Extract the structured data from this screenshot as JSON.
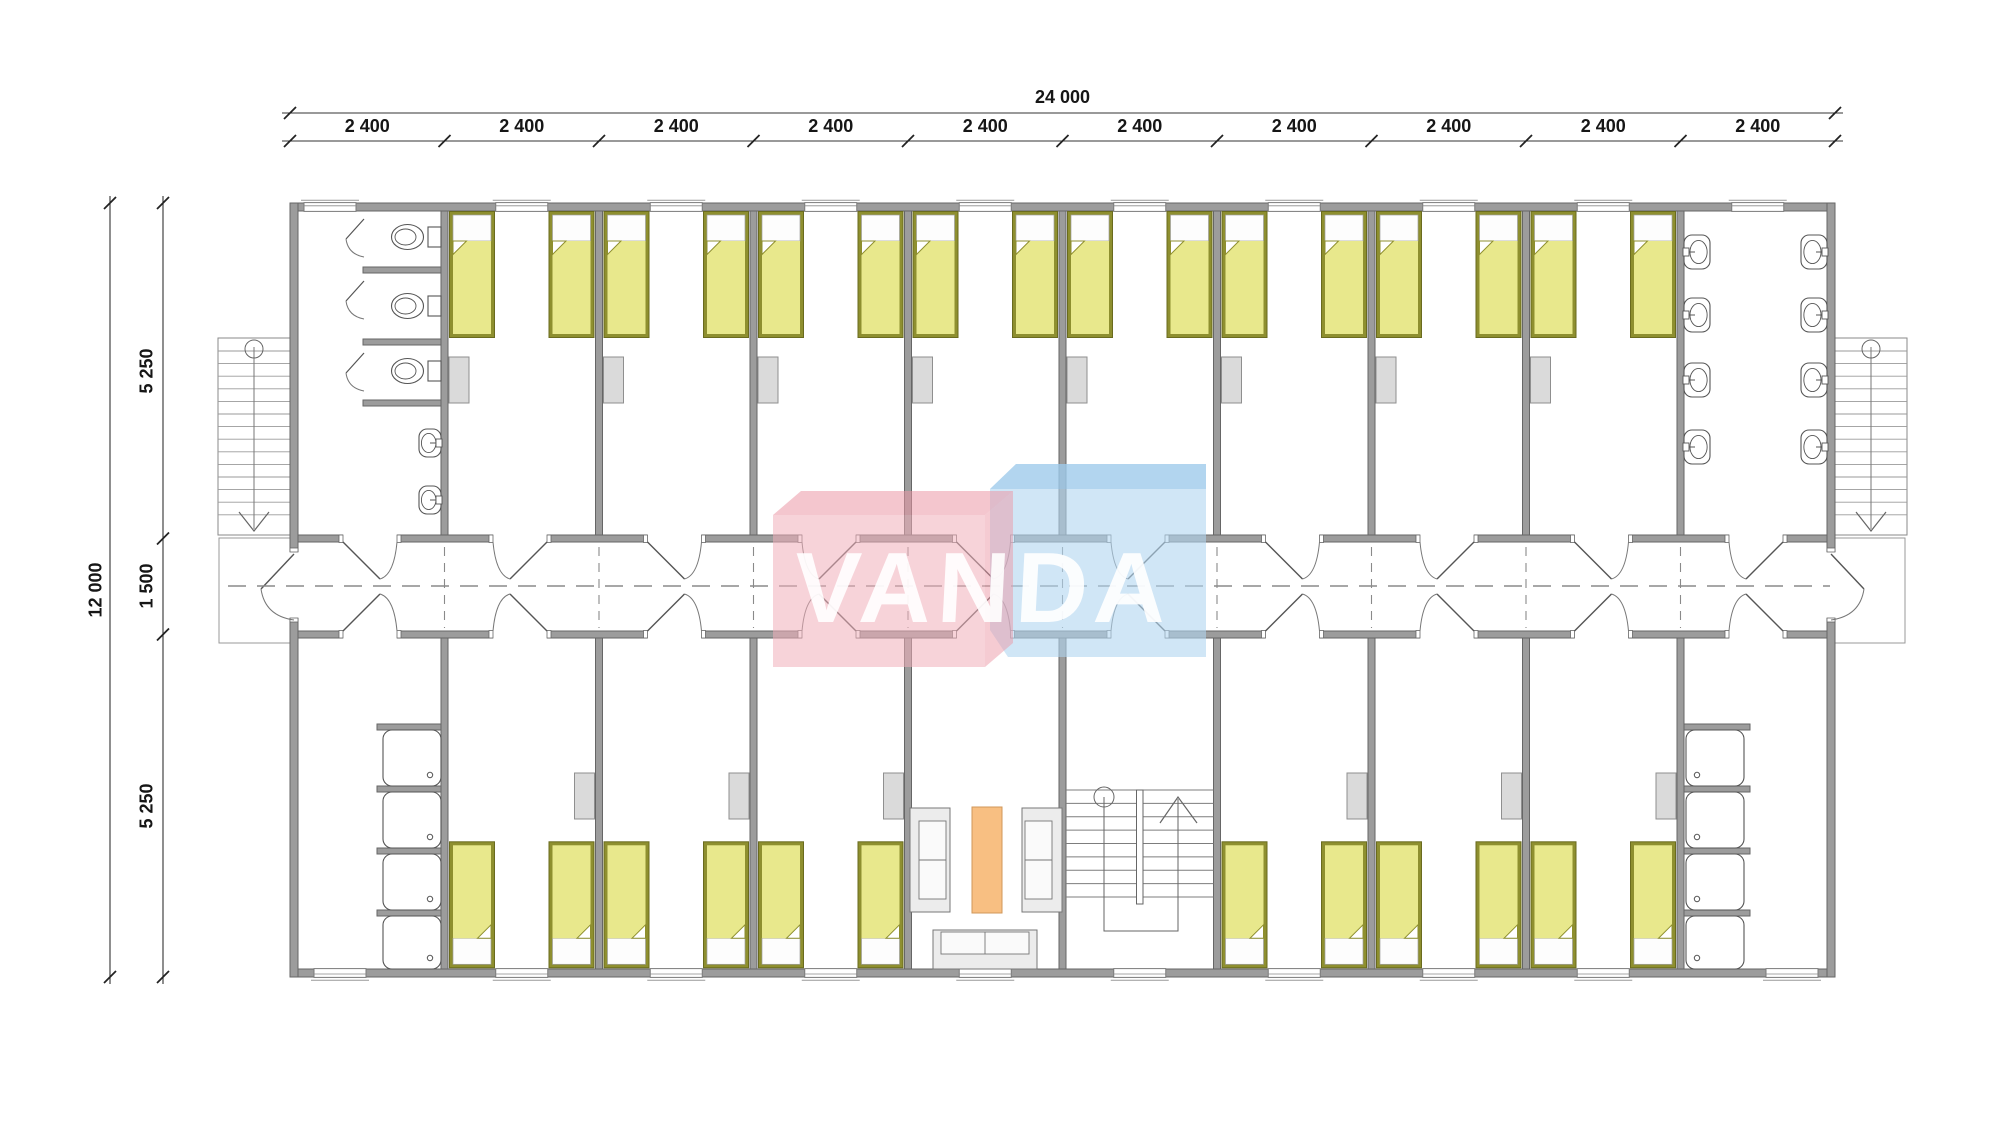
{
  "title": "Dormitory module floor plan",
  "brand": {
    "name": "VANDA"
  },
  "dimensions": {
    "top_total": {
      "label": "24 000"
    },
    "top_segments": [
      {
        "label": "2 400"
      },
      {
        "label": "2 400"
      },
      {
        "label": "2 400"
      },
      {
        "label": "2 400"
      },
      {
        "label": "2 400"
      },
      {
        "label": "2 400"
      },
      {
        "label": "2 400"
      },
      {
        "label": "2 400"
      },
      {
        "label": "2 400"
      },
      {
        "label": "2 400"
      }
    ],
    "left_total": {
      "label": "12 000"
    },
    "left_segments": [
      {
        "label": "5 250"
      },
      {
        "label": "1 500"
      },
      {
        "label": "5 250"
      }
    ]
  },
  "plan": {
    "grid": {
      "bays": 10,
      "bay_width_mm": 2400,
      "total_width_mm": 24000,
      "row_depths_mm": [
        5250,
        1500,
        5250
      ]
    },
    "top_rooms": [
      {
        "bay": 1,
        "type": "toilet-room",
        "toilets": 3,
        "urinals": 2
      },
      {
        "bay": 2,
        "type": "bedroom",
        "beds": 2,
        "locker": true
      },
      {
        "bay": 3,
        "type": "bedroom",
        "beds": 2,
        "locker": true
      },
      {
        "bay": 4,
        "type": "bedroom",
        "beds": 2,
        "locker": true
      },
      {
        "bay": 5,
        "type": "bedroom",
        "beds": 2,
        "locker": true
      },
      {
        "bay": 6,
        "type": "bedroom",
        "beds": 2,
        "locker": true
      },
      {
        "bay": 7,
        "type": "bedroom",
        "beds": 2,
        "locker": true
      },
      {
        "bay": 8,
        "type": "bedroom",
        "beds": 2,
        "locker": true
      },
      {
        "bay": 9,
        "type": "bedroom",
        "beds": 2,
        "locker": true
      },
      {
        "bay": 10,
        "type": "washroom",
        "basins": 8
      }
    ],
    "bottom_rooms": [
      {
        "bay": 1,
        "type": "shower-room",
        "showers": 4
      },
      {
        "bay": 2,
        "type": "bedroom",
        "beds": 2,
        "locker": true
      },
      {
        "bay": 3,
        "type": "bedroom",
        "beds": 2,
        "locker": true
      },
      {
        "bay": 4,
        "type": "bedroom",
        "beds": 2,
        "locker": true
      },
      {
        "bay": 5,
        "type": "lounge",
        "sofas": 3,
        "tables": 1
      },
      {
        "bay": 6,
        "type": "staircase"
      },
      {
        "bay": 7,
        "type": "bedroom",
        "beds": 2,
        "locker": true
      },
      {
        "bay": 8,
        "type": "bedroom",
        "beds": 2,
        "locker": true
      },
      {
        "bay": 9,
        "type": "bedroom",
        "beds": 2,
        "locker": true
      },
      {
        "bay": 10,
        "type": "shower-room",
        "showers": 4
      }
    ],
    "exterior_stairs": [
      "left",
      "right"
    ],
    "colors": {
      "wall_fill": "#9c9c9c",
      "wall_edge": "#666666",
      "bed_frame": "#8e8f2f",
      "bed_frame_edge": "#6a6b1e",
      "bed_blanket": "#e8e88c",
      "locker_fill": "#dadada",
      "fixture_line": "#555555",
      "sofa_fill": "#ececec",
      "table_fill": "#f8bf82",
      "table_edge": "#d0975a",
      "logo_pink": "#f0afb9",
      "logo_pink_dark": "#eb98a5",
      "logo_blue": "#b0d6f0",
      "logo_blue_dark": "#94c4e7",
      "dim_line": "#333333",
      "centerline": "#8a8a8a"
    }
  }
}
